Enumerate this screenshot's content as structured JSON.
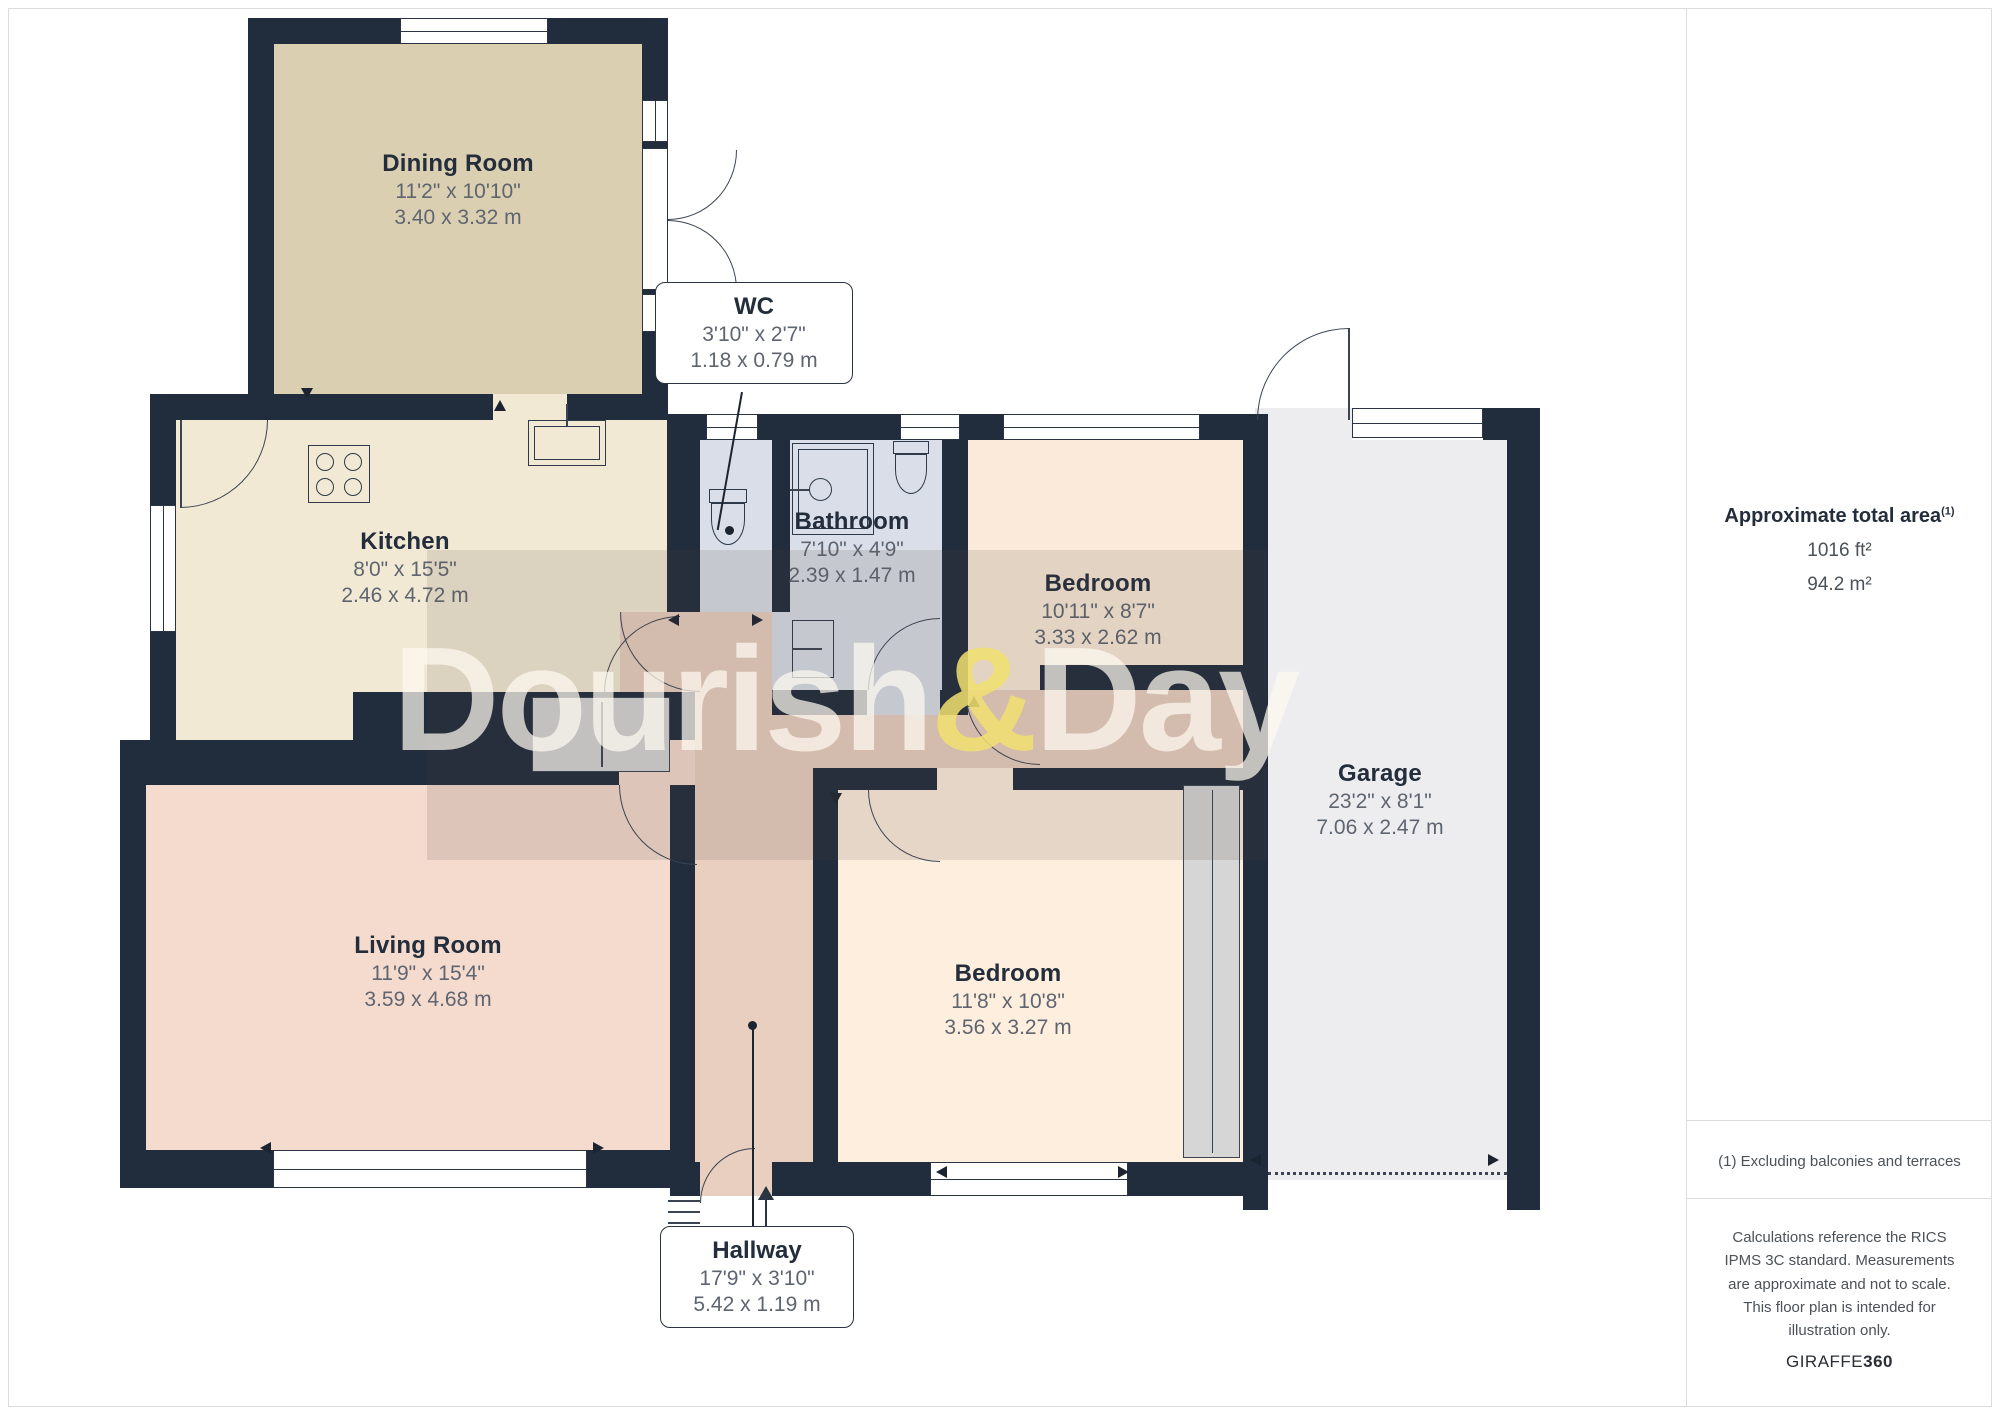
{
  "watermark": {
    "part1": "Dourish",
    "amp": "&",
    "part2": "Day"
  },
  "rooms": [
    {
      "name": "Dining Room",
      "imperial": "11'2\" x 10'10\"",
      "metric": "3.40 x 3.32 m"
    },
    {
      "name": "WC",
      "imperial": "3'10\" x 2'7\"",
      "metric": "1.18 x 0.79 m"
    },
    {
      "name": "Kitchen",
      "imperial": "8'0\" x 15'5\"",
      "metric": "2.46 x 4.72 m"
    },
    {
      "name": "Bathroom",
      "imperial": "7'10\" x 4'9\"",
      "metric": "2.39 x 1.47 m"
    },
    {
      "name": "Bedroom",
      "imperial": "10'11\" x 8'7\"",
      "metric": "3.33 x 2.62 m"
    },
    {
      "name": "Garage",
      "imperial": "23'2\" x 8'1\"",
      "metric": "7.06 x 2.47 m"
    },
    {
      "name": "Living Room",
      "imperial": "11'9\" x 15'4\"",
      "metric": "3.59 x 4.68 m"
    },
    {
      "name": "Bedroom",
      "imperial": "11'8\" x 10'8\"",
      "metric": "3.56 x 3.27 m"
    },
    {
      "name": "Hallway",
      "imperial": "17'9\" x 3'10\"",
      "metric": "5.42 x 1.19 m"
    }
  ],
  "sidebar": {
    "total_area_label": "Approximate total area",
    "total_area_superscript": "(1)",
    "area_ft": "1016 ft²",
    "area_m": "94.2 m²",
    "footnote": "(1) Excluding balconies and terraces",
    "disclaimer": "Calculations reference the RICS IPMS 3C standard. Measurements are approximate and not to scale. This floor plan is intended for illustration only.",
    "brand_name": "GIRAFFE",
    "brand_suffix": "360"
  },
  "colors": {
    "wall": "#212c3c",
    "dining": "#dbcfb1",
    "kitchen": "#f1e9d4",
    "hall": "#e8cfc0",
    "wet_rooms": "#d9dee8",
    "bedroom": "#fbead9",
    "living": "#f4dbcd",
    "garage": "#ededef",
    "watermark_amp": "#f0e16e"
  }
}
